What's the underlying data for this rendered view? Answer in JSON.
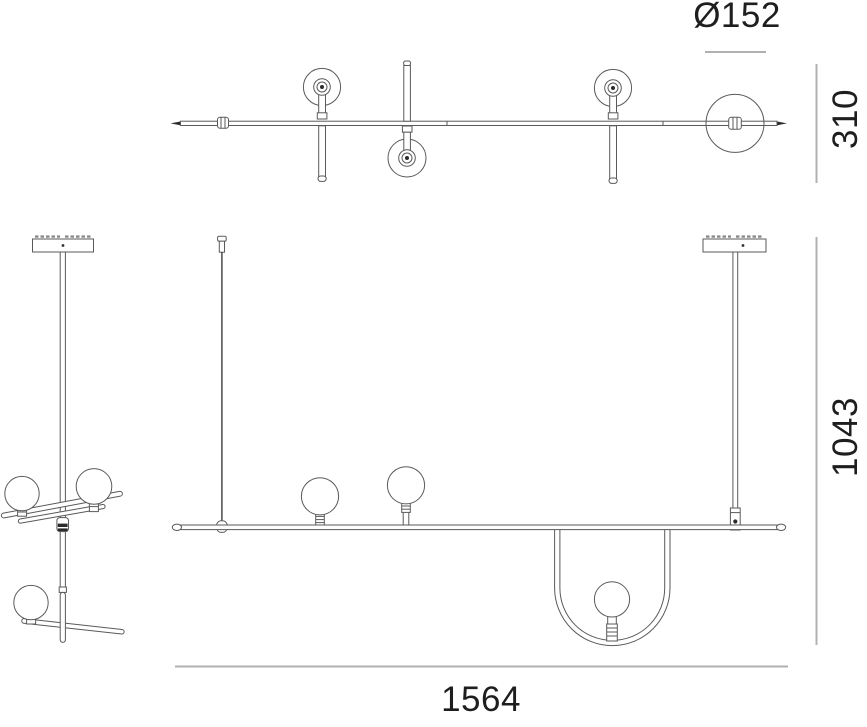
{
  "drawing": {
    "type": "technical-dimension-drawing",
    "subject": "suspension-lamp-three-views",
    "background_color": "#ffffff",
    "line_color": "#5a5a5a",
    "dimension_line_color": "#b0b0b0",
    "text_color": "#1e1e1e",
    "labels": {
      "sphere_diameter": "Ø152",
      "depth": "310",
      "height": "1043",
      "width": "1564"
    }
  }
}
